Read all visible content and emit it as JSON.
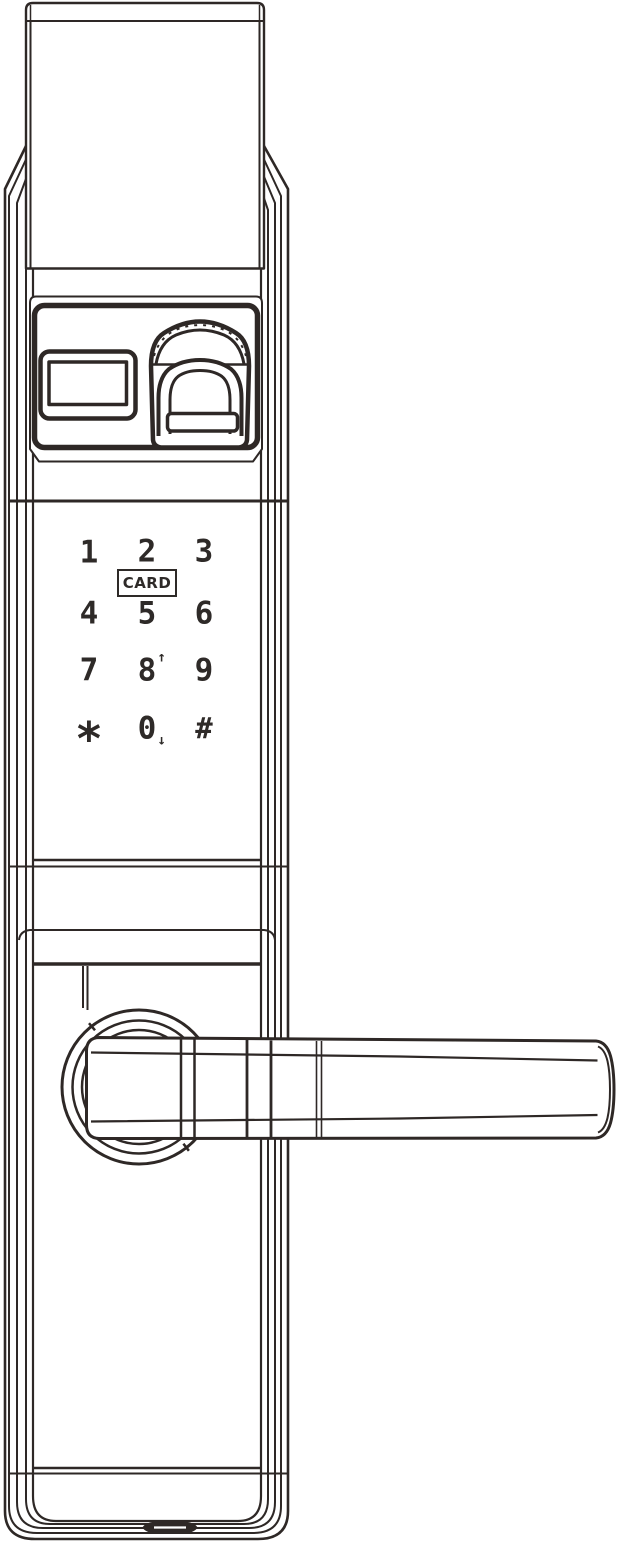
{
  "device": {
    "name": "smart-door-lock-front-view-line-drawing"
  },
  "colors": {
    "line": "#2e2826",
    "background": "#ffffff"
  },
  "keypad": {
    "card_label": "CARD",
    "keys": [
      {
        "label": "1"
      },
      {
        "label": "2"
      },
      {
        "label": "3"
      },
      {
        "label": "4"
      },
      {
        "label": "5"
      },
      {
        "label": "6"
      },
      {
        "label": "7"
      },
      {
        "label": "8",
        "suffix": "↑"
      },
      {
        "label": "9"
      },
      {
        "label": "*"
      },
      {
        "label": "0",
        "suffix": "↓"
      },
      {
        "label": "#"
      }
    ]
  }
}
